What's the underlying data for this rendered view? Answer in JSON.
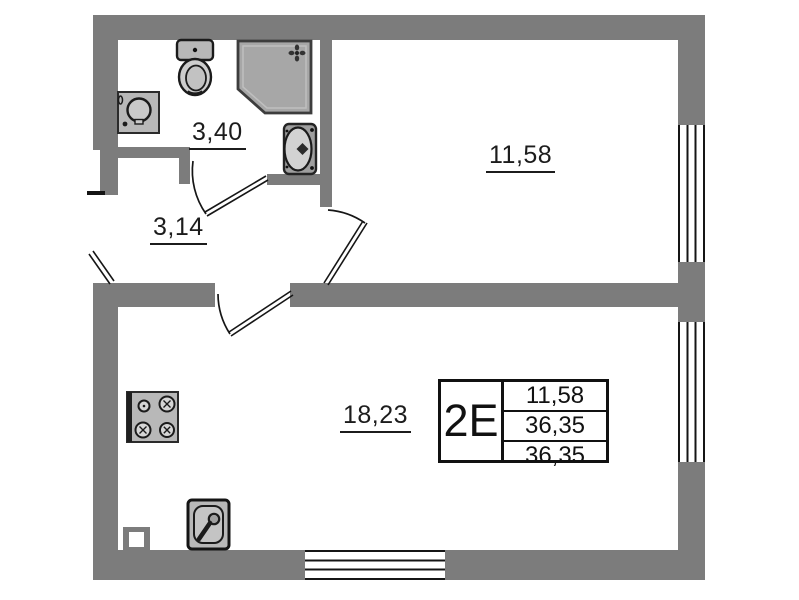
{
  "plan_title": "apartment-floor-plan",
  "rooms": [
    {
      "id": "bathroom",
      "label": "3,40"
    },
    {
      "id": "hallway",
      "label": "3,14"
    },
    {
      "id": "bedroom",
      "label": "11,58"
    },
    {
      "id": "kitchen-living-room",
      "label": "18,23"
    }
  ],
  "info_table": {
    "type_label": "2E",
    "rows": [
      "11,58",
      "36,35",
      "36,35"
    ]
  },
  "colors": {
    "wall": "#7c7c7c",
    "line": "#151515",
    "fixture_fill": "#b8b8b8",
    "shower_fill": "#a7a7a7",
    "background": "#ffffff"
  },
  "icons": {
    "toilet-icon": "svg:toilet-top-view",
    "shower-icon": "svg:corner-shower-cabin",
    "washbasin-icon": "svg:wall-washbasin",
    "washing-machine-icon": "svg:washing-machine-drum",
    "stove-icon": "svg:four-burner-stove",
    "kitchen-sink-icon": "svg:sink-with-faucet",
    "entrance-door-icon": "svg:door-leaf",
    "bathroom-door-icon": "svg:door-leaf-with-arc",
    "bedroom-door-icon": "svg:door-leaf-with-arc",
    "living-room-door-icon": "svg:door-leaf-with-arc",
    "window": "parallel-line-band",
    "vent-shaft-icon": "hollow-square"
  }
}
